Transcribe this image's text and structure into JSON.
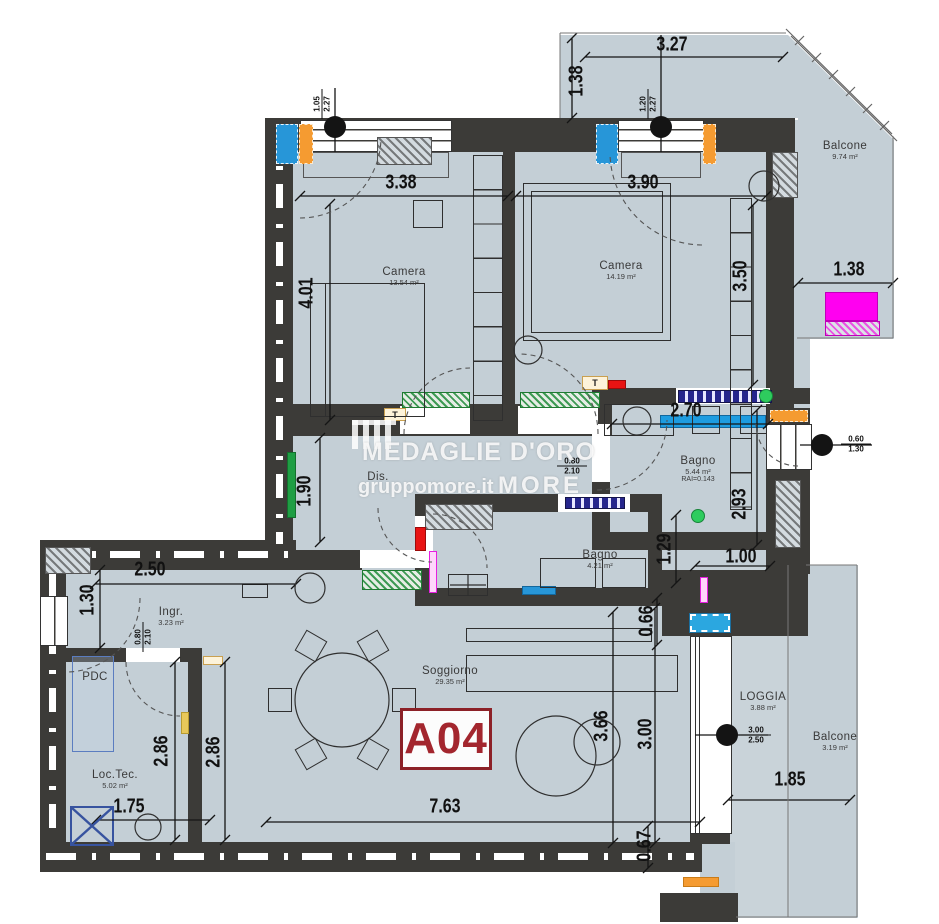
{
  "unit_badge": "A04",
  "watermark": {
    "brand": "MEDAGLIE D'ORO",
    "site": "gruppomore.it",
    "logo": "MORE"
  },
  "rooms": {
    "camera1": {
      "name": "Camera",
      "area": "13.54 m²"
    },
    "camera2": {
      "name": "Camera",
      "area": "14.19 m²"
    },
    "bagno1": {
      "name": "Bagno",
      "area": "5.44 m²",
      "rai": "RAI=0.143"
    },
    "bagno2": {
      "name": "Bagno",
      "area": "4.21 m²"
    },
    "dis": {
      "name": "Dis."
    },
    "ingr": {
      "name": "Ingr.",
      "area": "3.23 m²"
    },
    "soggiorno": {
      "name": "Soggiorno",
      "area": "29.35 m²"
    },
    "loctec": {
      "name": "Loc.Tec.",
      "area": "5.02 m²"
    },
    "pdc": {
      "name": "PDC"
    },
    "balcone_top": {
      "name": "Balcone",
      "area": "9.74 m²"
    },
    "loggia": {
      "name": "LOGGIA",
      "area": "3.88 m²"
    },
    "balcone_bottom": {
      "name": "Balcone",
      "area": "3.19 m²"
    }
  },
  "dims": {
    "d327": "3.27",
    "d138t": "1.38",
    "d338": "3.38",
    "d390": "3.90",
    "d401": "4.01",
    "d350": "3.50",
    "d138r": "1.38",
    "d270": "2.70",
    "d293": "2.93",
    "d190": "1.90",
    "d129": "1.29",
    "d100": "1.00",
    "d066": "0.66",
    "d250": "2.50",
    "d130": "1.30",
    "d286a": "2.86",
    "d286b": "2.86",
    "d366": "3.66",
    "d300": "3.00",
    "d763": "7.63",
    "d175": "1.75",
    "d067": "0.67",
    "d185": "1.85"
  },
  "tags": {
    "win1": {
      "a": "1.05",
      "b": "2.27"
    },
    "win2": {
      "a": "1.20",
      "b": "2.27"
    },
    "win3": {
      "a": "0.60",
      "b": "1.30"
    },
    "door1": {
      "a": "0.80",
      "b": "2.10"
    },
    "door2": {
      "a": "0.80",
      "b": "2.10"
    },
    "pdoor": {
      "a": "3.00",
      "b": "2.50"
    },
    "thermo": "T"
  },
  "colors": {
    "wall": "#3c3b38",
    "floor": "#c4cfd6",
    "accent_blue": "#2796d8",
    "accent_orange": "#f59b31",
    "accent_green": "#22b14c",
    "accent_red": "#e81313",
    "accent_magenta": "#f321e7",
    "badge_red": "#9c2730",
    "navy": "#23237a"
  }
}
